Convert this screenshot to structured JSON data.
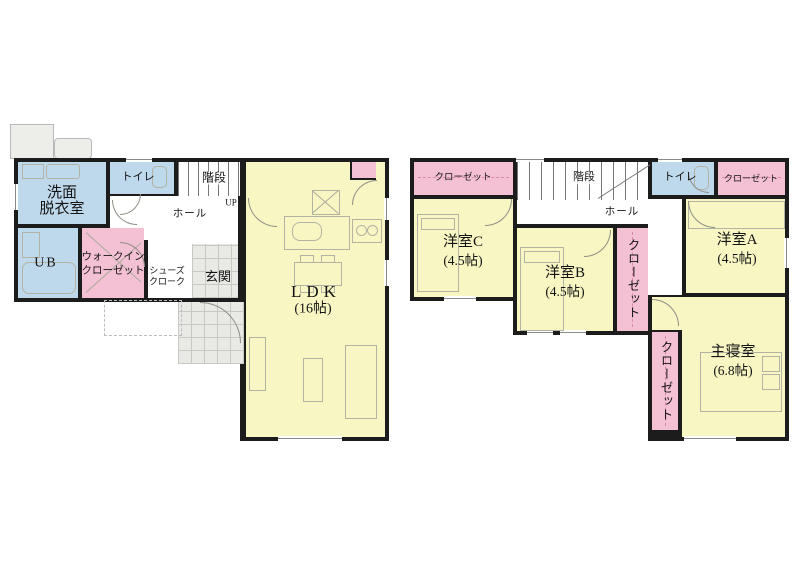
{
  "floor1": {
    "washroom": {
      "line1": "洗面",
      "line2": "脱衣室"
    },
    "toilet": "トイレ",
    "stairs": "階段",
    "up": "UP",
    "hall": "ホール",
    "ub": "UB",
    "wic": {
      "line1": "ウォークイン",
      "line2": "クローゼット"
    },
    "shoes": {
      "line1": "シューズ",
      "line2": "クローク"
    },
    "entrance": "玄関",
    "ldk": {
      "name": "LDK",
      "size": "(16帖)"
    }
  },
  "floor2": {
    "closet_c": "クローゼット",
    "room_c": {
      "name": "洋室C",
      "size": "(4.5帖)"
    },
    "stairs": "階段",
    "hall": "ホール",
    "toilet": "トイレ",
    "closet_a": "クローゼット",
    "room_a": {
      "name": "洋室A",
      "size": "(4.5帖)"
    },
    "room_b": {
      "name": "洋室B",
      "size": "(4.5帖)"
    },
    "closet_mid": "クローゼット",
    "closet_master": "クローゼット",
    "master": {
      "name": "主寝室",
      "size": "(6.8帖)"
    }
  },
  "colors": {
    "wall": "#1c1c1c",
    "room_blue": "#bfd9ec",
    "room_pink": "#f4c0d4",
    "room_yellow": "#f8f6c3",
    "tile_gray": "#e9e9e6"
  }
}
